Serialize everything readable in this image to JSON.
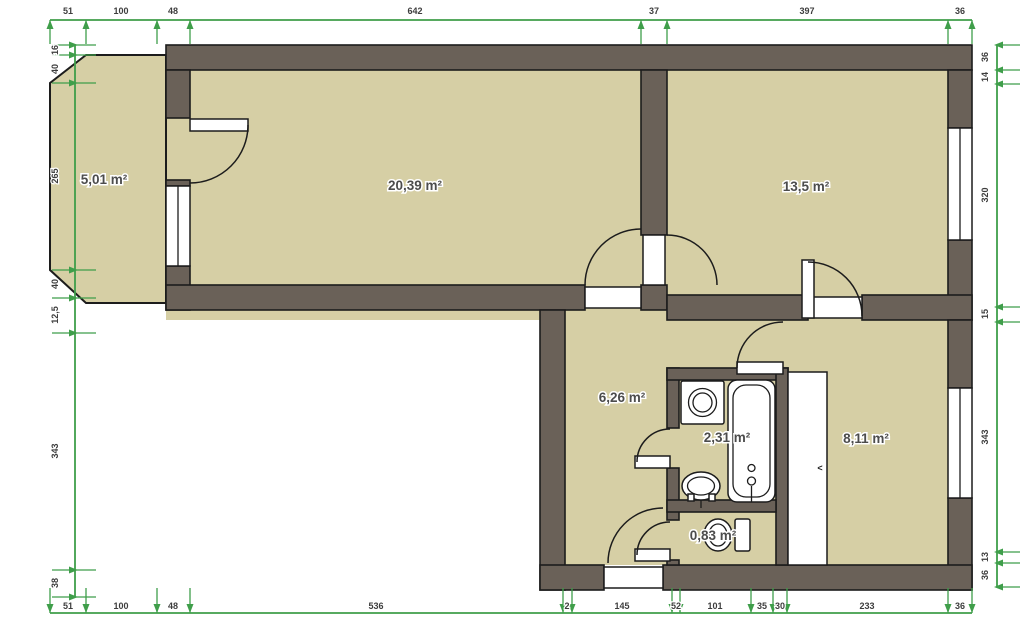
{
  "plan": {
    "rooms": [
      {
        "name": "balcony",
        "label": "5,01 m²"
      },
      {
        "name": "living-room",
        "label": "20,39 m²"
      },
      {
        "name": "bedroom",
        "label": "13,5 m²"
      },
      {
        "name": "hallway",
        "label": "6,26 m²"
      },
      {
        "name": "bathroom",
        "label": "2,31 m²"
      },
      {
        "name": "room-right",
        "label": "8,11 m²"
      },
      {
        "name": "wc",
        "label": "0,83 m²"
      }
    ],
    "dimensions": {
      "top": [
        "51",
        "100",
        "48",
        "642",
        "37",
        "397",
        "36"
      ],
      "bottom": [
        "51",
        "100",
        "48",
        "536",
        "2",
        "145",
        "52",
        "101",
        "35",
        "30",
        "233",
        "36"
      ],
      "left": [
        "16",
        "40",
        "265",
        "40",
        "12,5",
        "343",
        "38"
      ],
      "right": [
        "36",
        "14",
        "320",
        "15",
        "343",
        "13",
        "36"
      ]
    },
    "closet_marker": "<",
    "colors": {
      "wall": "#6a6158",
      "floor": "#d6cfa5",
      "dimension_line": "#3f9e4a",
      "outline": "#1c1c1c"
    }
  }
}
